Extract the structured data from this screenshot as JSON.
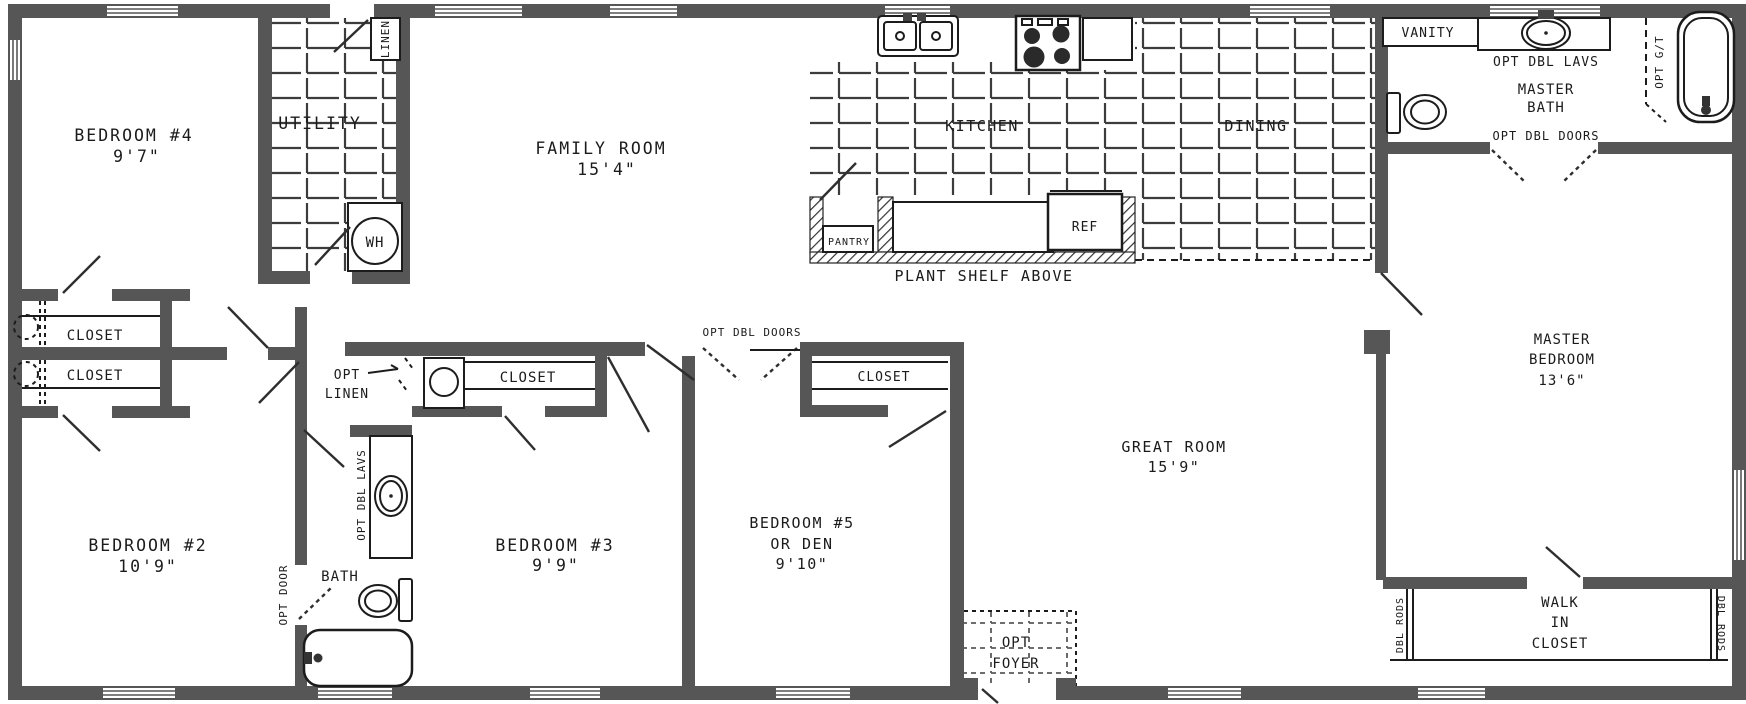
{
  "colors": {
    "wall": "#565656",
    "line": "#1c1c1c",
    "background": "#ffffff"
  },
  "rooms": {
    "bedroom4": {
      "name": "BEDROOM #4",
      "dim": "9'7\""
    },
    "bedroom2": {
      "name": "BEDROOM #2",
      "dim": "10'9\""
    },
    "bedroom3": {
      "name": "BEDROOM #3",
      "dim": "9'9\""
    },
    "bedroom5": {
      "name": "BEDROOM #5",
      "alt": "OR DEN",
      "dim": "9'10\""
    },
    "master_bedroom": {
      "name1": "MASTER",
      "name2": "BEDROOM",
      "dim": "13'6\""
    },
    "family_room": {
      "name": "FAMILY ROOM",
      "dim": "15'4\""
    },
    "great_room": {
      "name": "GREAT ROOM",
      "dim": "15'9\""
    },
    "kitchen": {
      "name": "KITCHEN"
    },
    "dining": {
      "name": "DINING"
    },
    "utility": {
      "name": "UTILITY"
    },
    "master_bath": {
      "name1": "MASTER",
      "name2": "BATH"
    },
    "hall_bath": {
      "name": "BATH"
    },
    "walk_in_closet": {
      "name1": "WALK",
      "name2": "IN",
      "name3": "CLOSET"
    },
    "opt_foyer": {
      "name1": "OPT",
      "name2": "FOYER"
    }
  },
  "features": {
    "linen": "LINEN",
    "water_heater": "WH",
    "pantry": "PANTRY",
    "refrigerator": "REF",
    "plant_shelf": "PLANT SHELF ABOVE",
    "vanity": "VANITY",
    "opt_dbl_lavs_master": "OPT DBL LAVS",
    "opt_dbl_doors_master": "OPT DBL DOORS",
    "opt_garden_tub": "OPT G/T",
    "closet_left_top": "CLOSET",
    "closet_left_bottom": "CLOSET",
    "closet_bed3": "CLOSET",
    "closet_bed5": "CLOSET",
    "opt_linen1": "OPT",
    "opt_linen2": "LINEN",
    "opt_dbl_doors_hall": "OPT DBL DOORS",
    "opt_door": "OPT DOOR",
    "opt_dbl_lavs_hall": "OPT DBL LAVS",
    "dbl_rods_left": "DBL RODS",
    "dbl_rods_right": "DBL RODS"
  }
}
